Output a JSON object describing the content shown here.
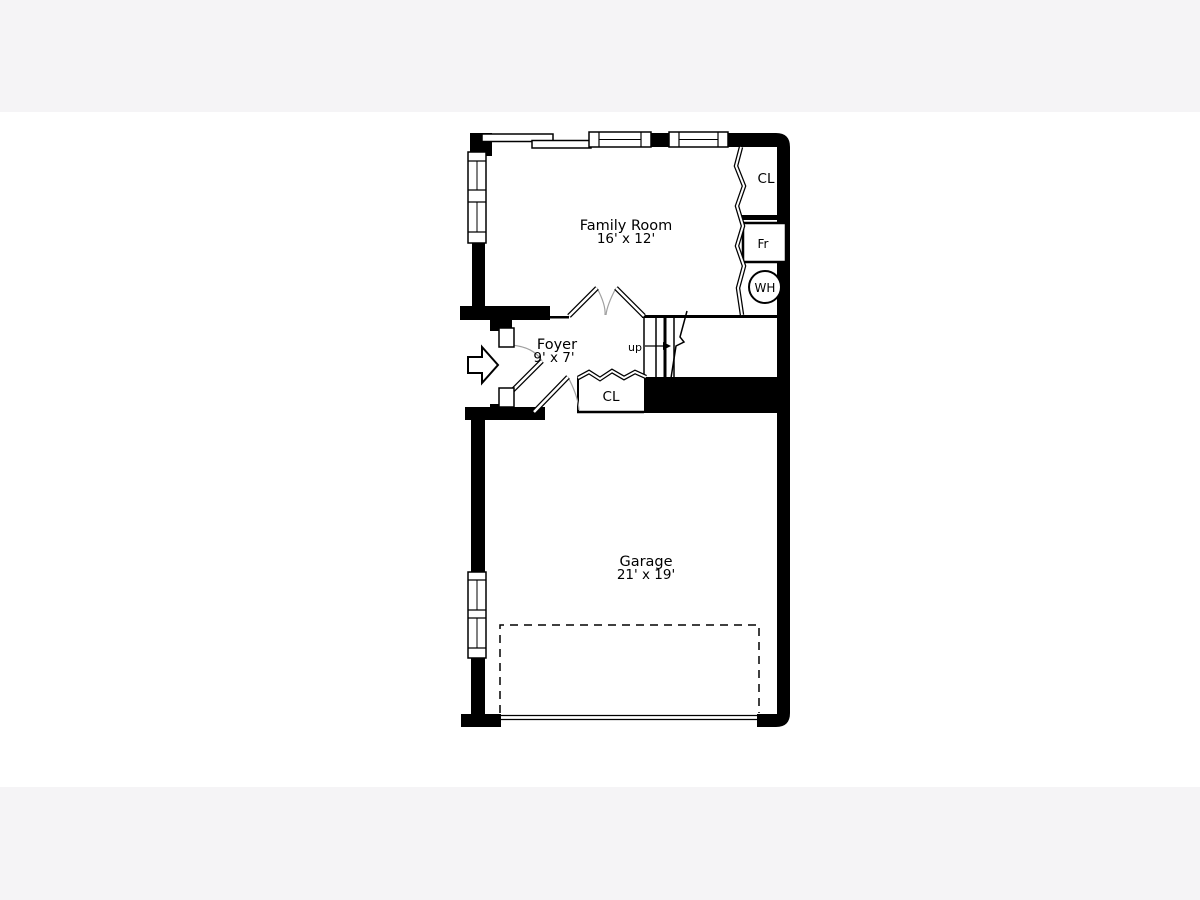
{
  "plan": {
    "rooms": {
      "family_room": {
        "name": "Family Room",
        "dims": "16' x 12'"
      },
      "foyer": {
        "name": "Foyer",
        "dims": "9' x 7'"
      },
      "garage": {
        "name": "Garage",
        "dims": "21' x 19'"
      }
    },
    "labels": {
      "closet_upper": "CL",
      "closet_foyer": "CL",
      "furnace": "Fr",
      "water_heater": "WH",
      "stairs_direction": "up"
    },
    "colors": {
      "ink": "#000000",
      "door_swing_arc": "#a0a0a0",
      "sheet": "#ffffff",
      "margin_band": "#f5f4f6"
    }
  }
}
